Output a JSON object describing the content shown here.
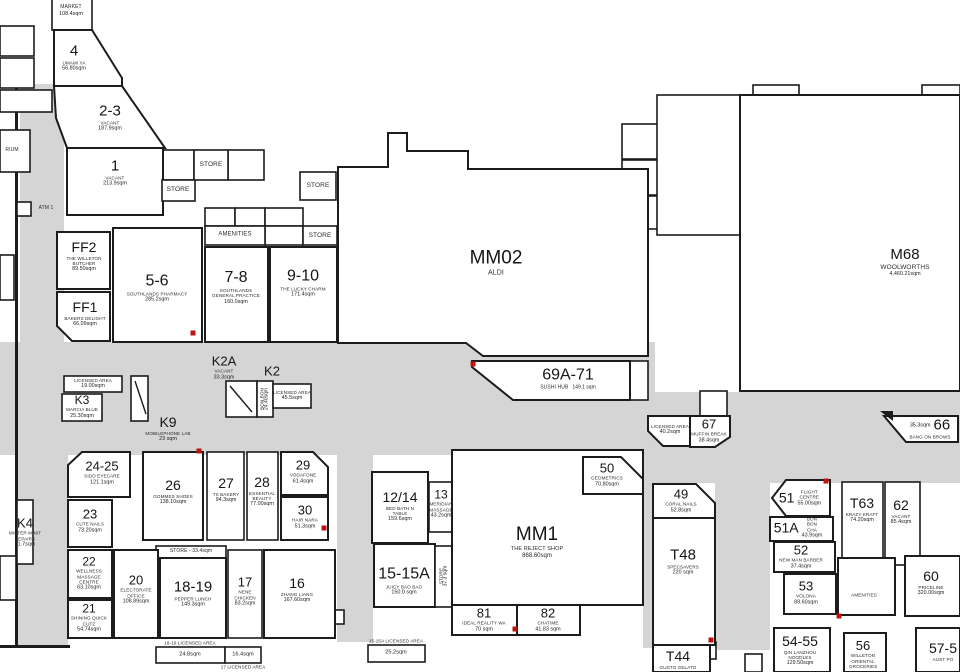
{
  "colors": {
    "corridor": "#d5d5d5",
    "wall": "#1c1c1c",
    "tenancy_fill": "#ffffff",
    "door_marker": "#c11212"
  },
  "units": [
    {
      "key": "market",
      "unit": "",
      "name": "MARKET",
      "area": "108.4sqm"
    },
    {
      "key": "t4",
      "unit": "4",
      "name": "UMAMI YA",
      "area": "56.80sqm"
    },
    {
      "key": "t2_3",
      "unit": "2-3",
      "name": "VACANT",
      "area": "187.9sqm"
    },
    {
      "key": "t1",
      "unit": "1",
      "name": "VACANT",
      "area": "213.9sqm"
    },
    {
      "key": "store_a",
      "unit": "",
      "name": "STORE",
      "area": ""
    },
    {
      "key": "store_b",
      "unit": "",
      "name": "STORE",
      "area": ""
    },
    {
      "key": "store_c",
      "unit": "",
      "name": "STORE",
      "area": ""
    },
    {
      "key": "store_d",
      "unit": "",
      "name": "STORE",
      "area": ""
    },
    {
      "key": "amen_top",
      "unit": "",
      "name": "AMENITIES",
      "area": ""
    },
    {
      "key": "ff2",
      "unit": "FF2",
      "name": "THE WILLETON BUTCHER",
      "area": "89.50sqm"
    },
    {
      "key": "ff1",
      "unit": "FF1",
      "name": "BAKERS DELIGHT",
      "area": "66.09sqm"
    },
    {
      "key": "t5_6",
      "unit": "5-6",
      "name": "SOUTHLANDS PHARMACY",
      "area": "285.2sqm"
    },
    {
      "key": "t7_8",
      "unit": "7-8",
      "name": "SOUTHLANDS GENERAL PRACTICE",
      "area": "160.0sqm"
    },
    {
      "key": "t9_10",
      "unit": "9-10",
      "name": "THE LUCKY CHARM",
      "area": "171.4sqm"
    },
    {
      "key": "mm02",
      "unit": "MM02",
      "name": "ALDI",
      "area": ""
    },
    {
      "key": "m68",
      "unit": "M68",
      "name": "WOOLWORTHS",
      "area": "4,460.21sqm"
    },
    {
      "key": "t69a_71",
      "unit": "69A-71",
      "name": "SUSHI HUB",
      "area": "149.1 sqm"
    },
    {
      "key": "lic67",
      "unit": "",
      "name": "LICENSED AREA",
      "area": "40.2sqm"
    },
    {
      "key": "t67",
      "unit": "67",
      "name": "MUFFIN BREAK",
      "area": "38.4sqm"
    },
    {
      "key": "t66",
      "unit": "66",
      "name": "BANG ON BROWS",
      "area": "35.3sqm"
    },
    {
      "key": "k3lic",
      "unit": "",
      "name": "LICENSED AREA",
      "area": "19.00sqm"
    },
    {
      "key": "k3",
      "unit": "K3",
      "name": "MARCIA BLUE",
      "area": "25.30sqm"
    },
    {
      "key": "k9",
      "unit": "K9",
      "name": "MOBILEPHONE LAB",
      "area": "23 sqm"
    },
    {
      "key": "k2a",
      "unit": "K2A",
      "name": "VACANT",
      "area": "33.3sqm"
    },
    {
      "key": "k2strip",
      "unit": "",
      "name": "BON BON",
      "area": "24.40sqm"
    },
    {
      "key": "k2",
      "unit": "K2",
      "name": "",
      "area": ""
    },
    {
      "key": "k2lic",
      "unit": "",
      "name": "LICENSED AREA",
      "area": "45.5sqm"
    },
    {
      "key": "t24_25",
      "unit": "24-25",
      "name": "SIDO EYECARE",
      "area": "121.1sqm"
    },
    {
      "key": "t26",
      "unit": "26",
      "name": "GOMMES SHOES",
      "area": "138.10sqm"
    },
    {
      "key": "t27",
      "unit": "27",
      "name": "TS BAKERY",
      "area": "94.3sqm"
    },
    {
      "key": "t28",
      "unit": "28",
      "name": "ESSENTIAL BEAUTY",
      "area": "77.00sqm"
    },
    {
      "key": "t29",
      "unit": "29",
      "name": "VODAFONE",
      "area": "61.4sqm"
    },
    {
      "key": "t30",
      "unit": "30",
      "name": "HAIR NARA",
      "area": "51.3sqm"
    },
    {
      "key": "t23",
      "unit": "23",
      "name": "CUTE NAILS",
      "area": "73.20sqm"
    },
    {
      "key": "store_e",
      "unit": "",
      "name": "STORE - 33.4sqm",
      "area": ""
    },
    {
      "key": "t22",
      "unit": "22",
      "name": "WELLNESS MASSAGE CENTRE",
      "area": "63.10sqm"
    },
    {
      "key": "t21",
      "unit": "21",
      "name": "SHINING QUICK CUTZ",
      "area": "54.74sqm"
    },
    {
      "key": "t20",
      "unit": "20",
      "name": "ELECTORATE OFFICE",
      "area": "108.89sqm"
    },
    {
      "key": "t18_19",
      "unit": "18-19",
      "name": "PEPPER LUNCH",
      "area": "149.3sqm"
    },
    {
      "key": "t17",
      "unit": "17",
      "name": "NENE CHICKEN",
      "area": "83.2sqm"
    },
    {
      "key": "t16",
      "unit": "16",
      "name": "ZHANG LIANG",
      "area": "167.60sqm"
    },
    {
      "key": "lic18_19",
      "unit": "",
      "name": "18-19 LICENSED AREA",
      "area": ""
    },
    {
      "key": "b24_8",
      "unit": "",
      "name": "",
      "area": "24.8sqm"
    },
    {
      "key": "b16_4",
      "unit": "",
      "name": "",
      "area": "16.4sqm"
    },
    {
      "key": "lic17",
      "unit": "",
      "name": "17 LICENSED AREA",
      "area": ""
    },
    {
      "key": "lic15",
      "unit": "",
      "name": "15-15A LICENSED AREA",
      "area": ""
    },
    {
      "key": "b25_2",
      "unit": "",
      "name": "",
      "area": "25.2sqm"
    },
    {
      "key": "t12_14",
      "unit": "12/14",
      "name": "BED BATH N TABLE",
      "area": "159.6sqm"
    },
    {
      "key": "t13",
      "unit": "13",
      "name": "MERIDIAN MASSAGE",
      "area": "43.2sqm"
    },
    {
      "key": "t15_15a",
      "unit": "15-15A",
      "name": "JUICY BAO BAO",
      "area": "150.0 sqm"
    },
    {
      "key": "store_f",
      "unit": "",
      "name": "STORE",
      "area": "37.3 sqm"
    },
    {
      "key": "mm1",
      "unit": "MM1",
      "name": "THE REJECT SHOP",
      "area": "868.60sqm"
    },
    {
      "key": "t50",
      "unit": "50",
      "name": "GEOMETRICS",
      "area": "70.80sqm"
    },
    {
      "key": "t81",
      "unit": "81",
      "name": "IDEAL REALITY WA",
      "area": "70 sqm"
    },
    {
      "key": "t82",
      "unit": "82",
      "name": "CHATIME",
      "area": "41.83 sqm"
    },
    {
      "key": "t49",
      "unit": "49",
      "name": "CORAL NAILS",
      "area": "52.8sqm"
    },
    {
      "key": "t48",
      "unit": "T48",
      "name": "SPECSAVERS",
      "area": "220 sqm"
    },
    {
      "key": "t44",
      "unit": "T44",
      "name": "GUSTO GELATO",
      "area": ""
    },
    {
      "key": "t51",
      "unit": "51",
      "name": "FLIGHT CENTRE",
      "area": "55.00sqm"
    },
    {
      "key": "t51a",
      "unit": "51A",
      "name": "BON BON CHA",
      "area": "43.9sqm"
    },
    {
      "key": "t52",
      "unit": "52",
      "name": "NEW MAN BARBER",
      "area": "37.4sqm"
    },
    {
      "key": "t53",
      "unit": "53",
      "name": "VOLONA",
      "area": "89.60sqm"
    },
    {
      "key": "t54_55",
      "unit": "54-55",
      "name": "QIN LANZHOU NOODLES",
      "area": "129.50sqm"
    },
    {
      "key": "t56",
      "unit": "56",
      "name": "WILLETON ORIENTAL GROCERIES",
      "area": ""
    },
    {
      "key": "t57",
      "unit": "57-5",
      "name": "AUST PO",
      "area": ""
    },
    {
      "key": "t63",
      "unit": "T63",
      "name": "KRAZY KRAFT",
      "area": "74.20sqm"
    },
    {
      "key": "t62",
      "unit": "62",
      "name": "VACANT",
      "area": "85.4sqm"
    },
    {
      "key": "t60",
      "unit": "60",
      "name": "PRICELINE",
      "area": "320.00sqm"
    },
    {
      "key": "amen_r",
      "unit": "",
      "name": "AMENITIES",
      "area": ""
    },
    {
      "key": "k4",
      "unit": "K4",
      "name": "MISTER MINIT REPAIRS",
      "area": "21.7sqm"
    },
    {
      "key": "atm",
      "unit": "",
      "name": "ATM 1",
      "area": ""
    },
    {
      "key": "rium",
      "unit": "",
      "name": "RIUM",
      "area": ""
    }
  ]
}
